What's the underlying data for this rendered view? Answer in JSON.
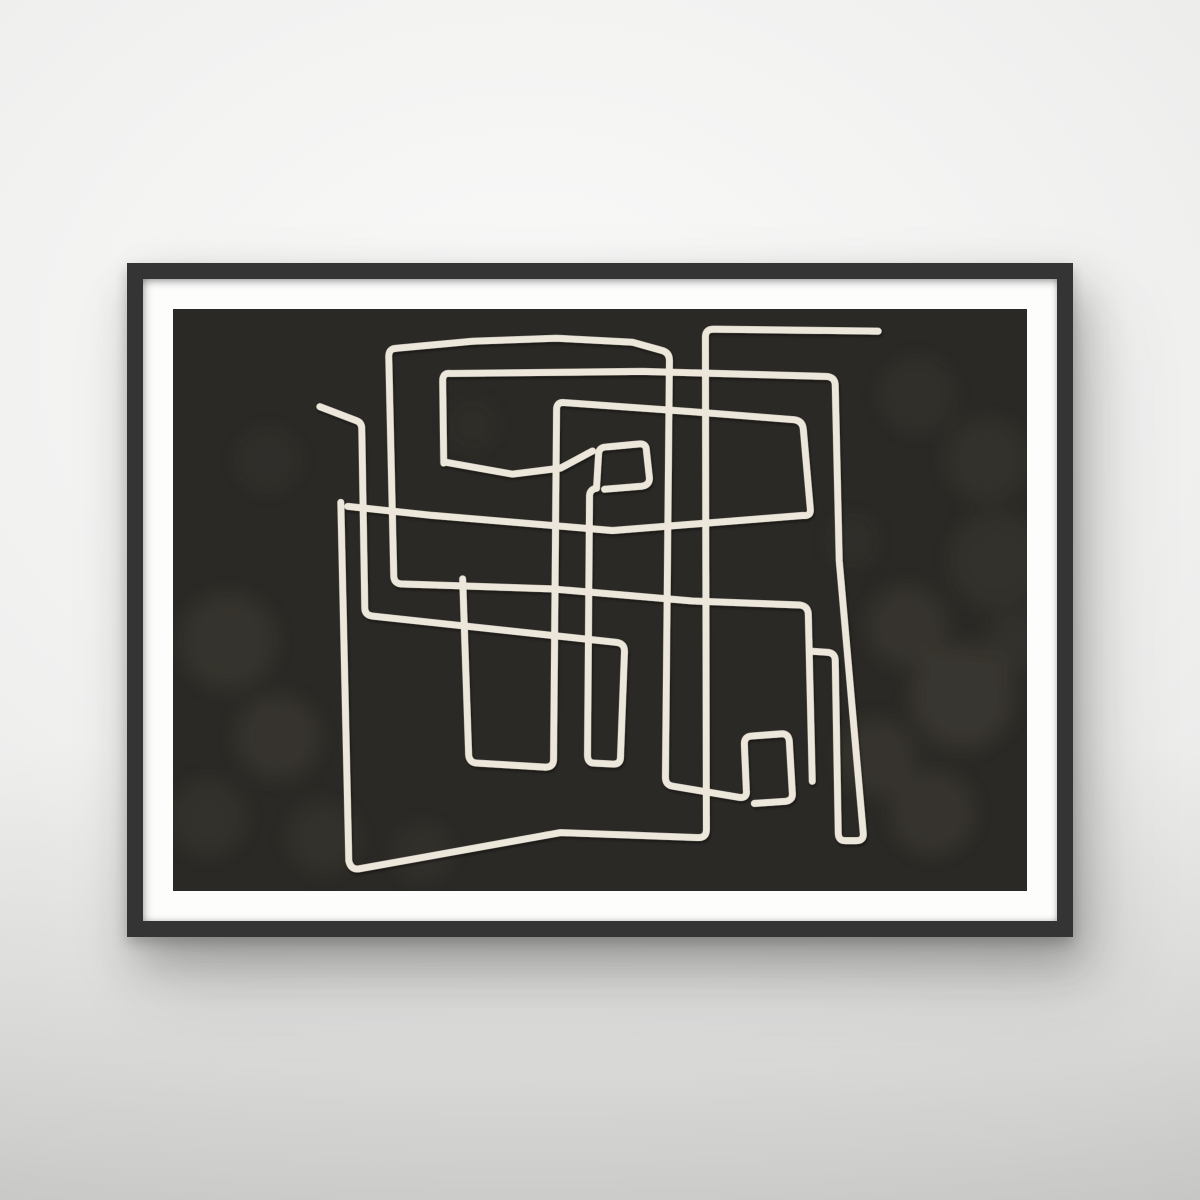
{
  "scene": {
    "description": "Photograph of a wall-hung poster in a thin black frame with a white mat; the print is an abstract hand-drawn continuous-line maze of rectangular meanders in cream on a dark charcoal background",
    "wall": "empty light-gray wall with soft lighting, darker toward the bottom",
    "shadow": "soft drop shadow cast by the frame down and to the right"
  },
  "artwork": {
    "subject": "abstract maze line art",
    "style": "single-line rectangular meander, hand-drawn with slightly wobbly strokes and rounded corners",
    "elements": {
      "line_count_appearance": "one continuous looping line plus a short free-ended stub",
      "small_shapes": [
        "small rounded square left of center",
        "small rounded rectangle lower right of center",
        "tall narrow U at right",
        "large open rectangle lower left"
      ],
      "free_line_ends": 4,
      "texture": "faint mottled lighter blotches on the charcoal ground"
    }
  },
  "css_vars": {
    "wall-highlight": "#fafaf9",
    "wall-base": "#f0f0ef",
    "wall-mid": "#e6e6e5",
    "wall-shadow": "#d6d6d5",
    "frame-color": "#343434",
    "mat-color": "#fdfdfc",
    "art-bg": "#2b2925",
    "line-color": "#ece7da",
    "blotch-color": "#9b9681",
    "frame-left": "127px",
    "frame-top": "263px",
    "frame-width": "946px",
    "frame-height": "674px",
    "frame-border": "16px",
    "mat-border": "30px"
  }
}
